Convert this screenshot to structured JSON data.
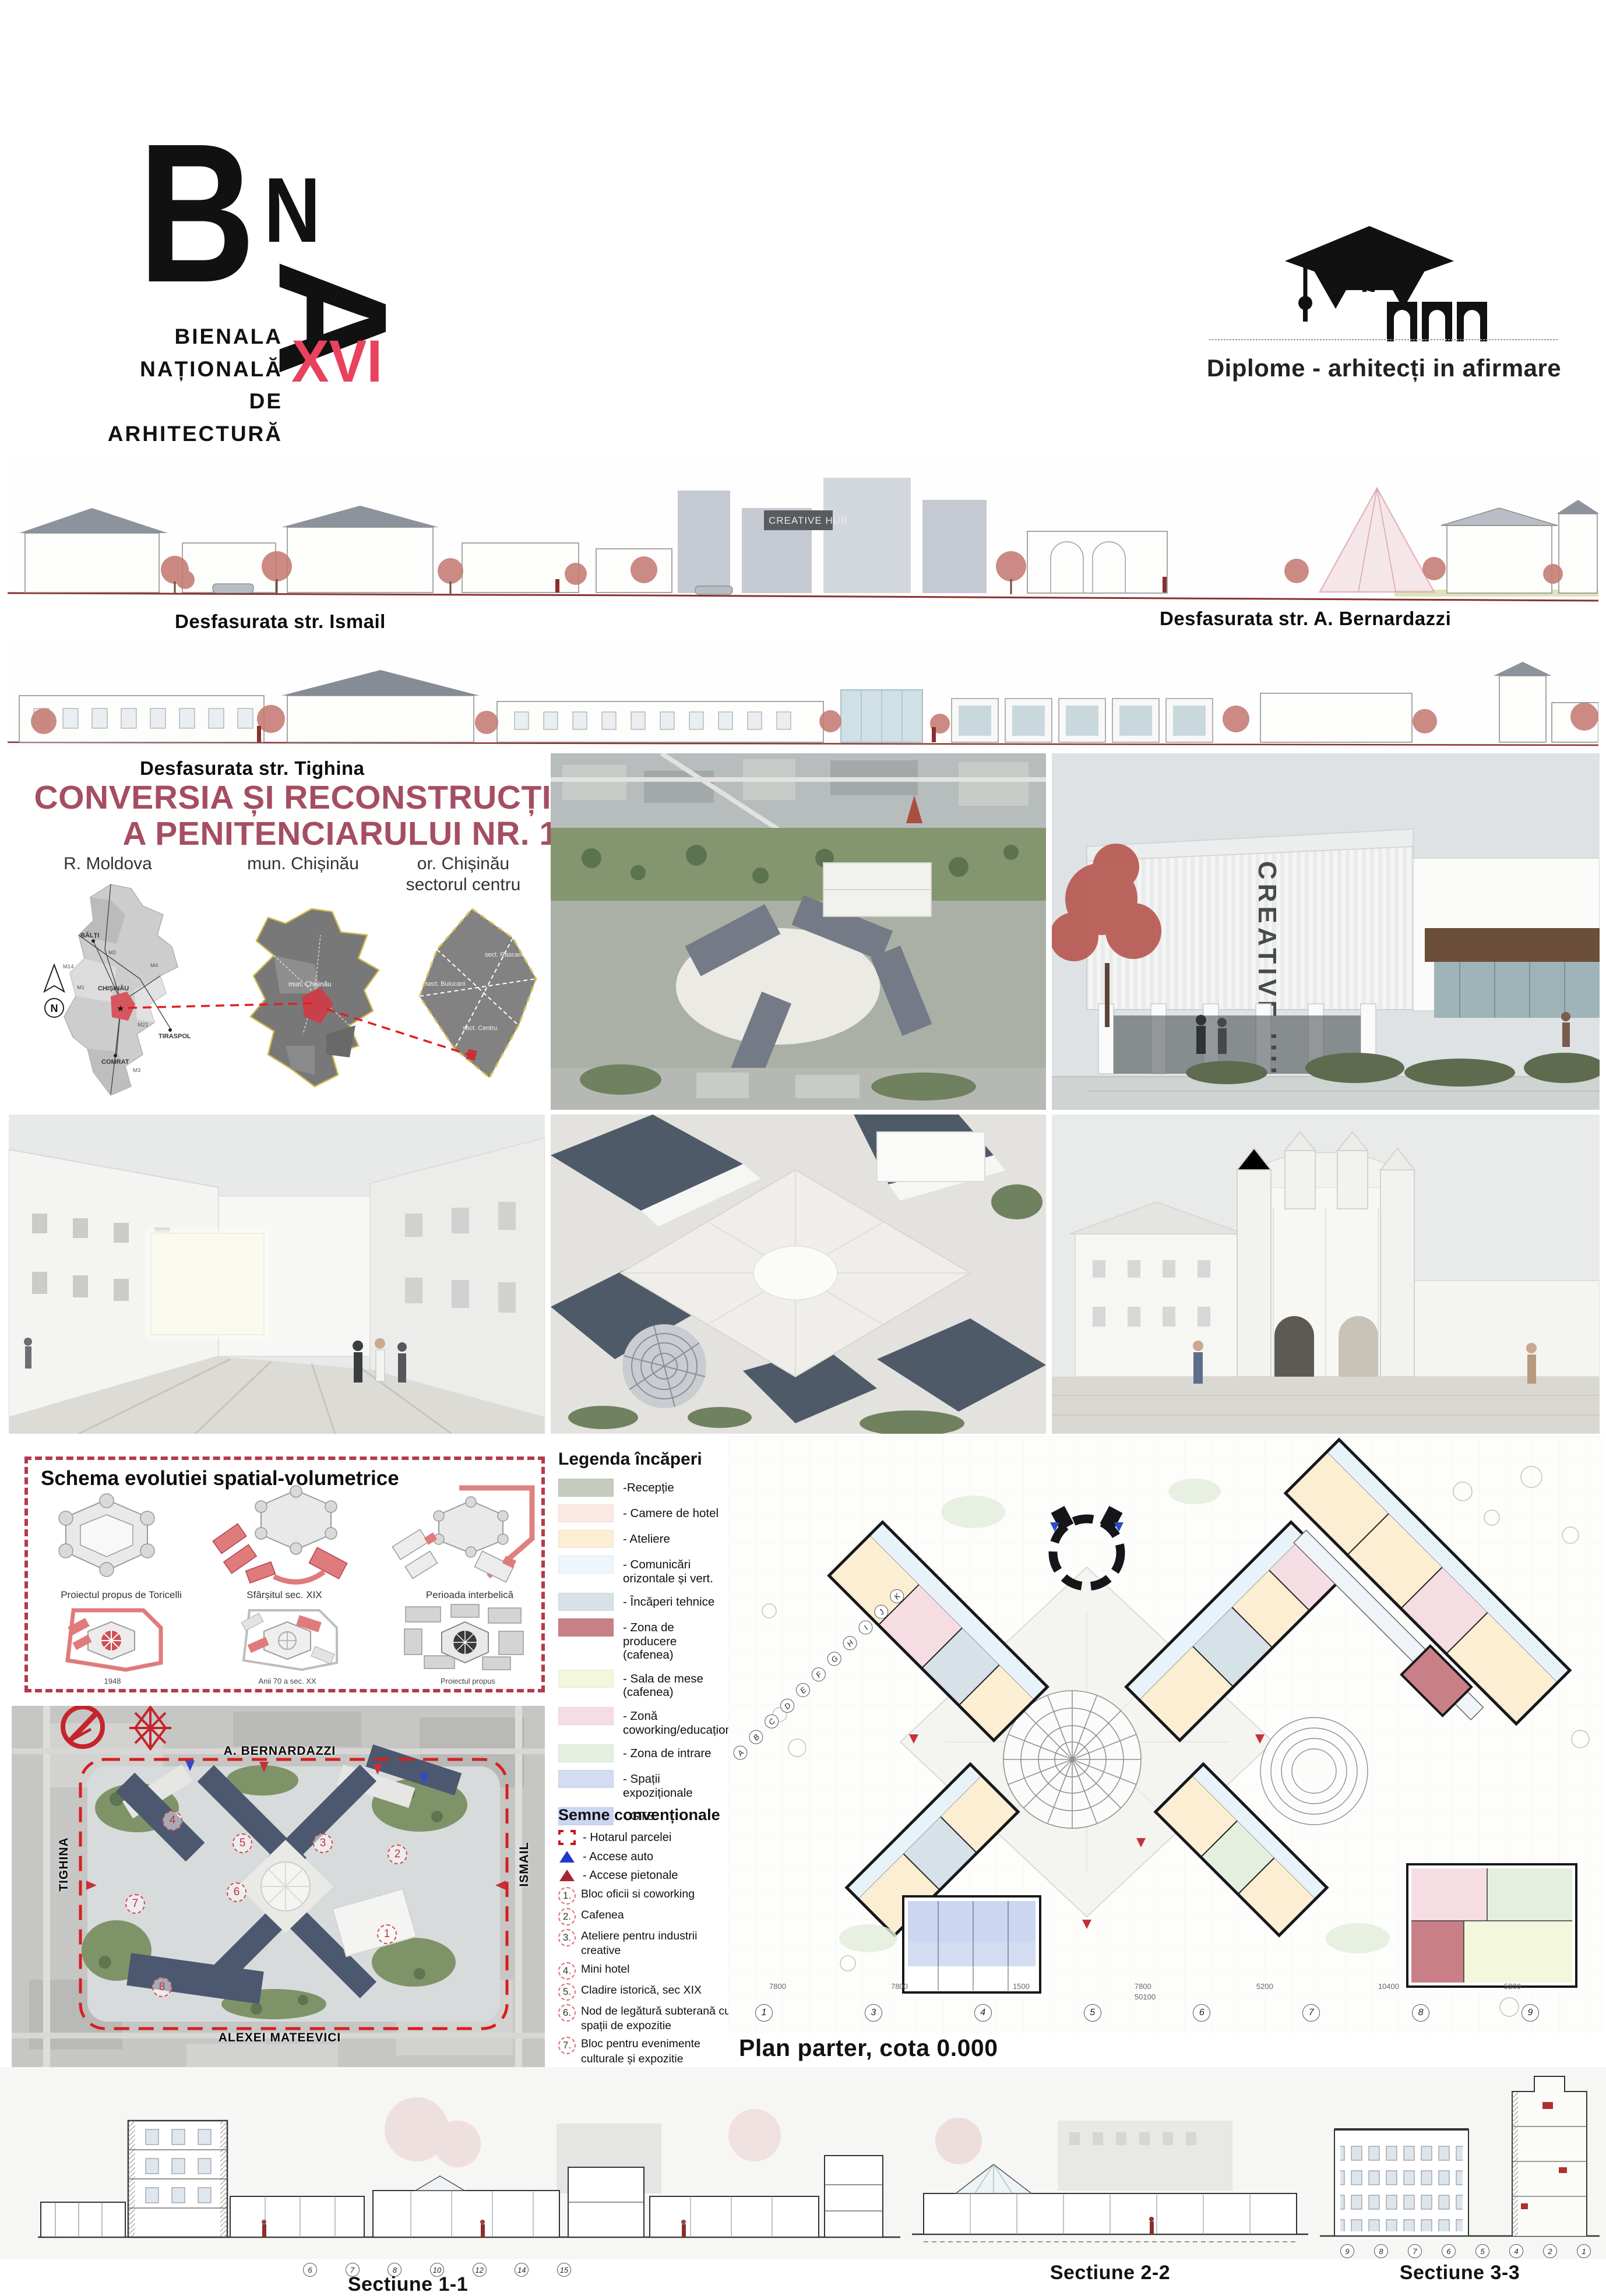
{
  "header": {
    "bna": {
      "letter_b": "B",
      "letter_n": "N",
      "letter_a": "A",
      "title_lines": [
        "BIENALA",
        "NAȚIONALĂ",
        "DE",
        "ARHITECTURĂ"
      ],
      "year": "2025",
      "edition": "XVI"
    },
    "diplome": {
      "label": "Diplome - arhitecți in afirmare"
    }
  },
  "elevations": {
    "ismail": "Desfasurata str. Ismail",
    "bernardazzi": "Desfasurata str. A. Bernardazzi",
    "tighina": "Desfasurata str. Tighina",
    "mateevici": "Desfasurata str. A. Mateevici"
  },
  "project_title": {
    "line1": "CONVERSIA ȘI RECONSTRUCȚIA CLĂDIRII ISTORICE",
    "line2": "A PENITENCIARULUI NR. 13, or. CHIȘINĂU"
  },
  "maps": {
    "north": "N",
    "moldova": {
      "label": "R. Moldova",
      "cities": [
        "BĂLȚI",
        "CHIȘINĂU",
        "TIRASPOL",
        "COMRAT"
      ],
      "roads": [
        "M1",
        "M2",
        "M3",
        "M4",
        "M14",
        "M21"
      ]
    },
    "municipality": {
      "label": "mun. Chișinău",
      "annotation": "mun. Chișinău"
    },
    "sector": {
      "label_line1": "or. Chișinău",
      "label_line2": "sectorul centru",
      "sectors": [
        "sect. Rascani",
        "sect. Buiucani",
        "sect. Centru"
      ]
    }
  },
  "renders": {
    "creative_hub_sign": "CREATIVE HUB"
  },
  "schema": {
    "title": "Schema evolutiei spatial-volumetrice",
    "stages_top": [
      "Proiectul propus de Toricelli",
      "Sfârșitul sec. XIX",
      "Perioada interbelică"
    ],
    "stages_bottom": [
      "1948",
      "Anii 70 a sec. XX",
      "Proiectul propus"
    ]
  },
  "site_plan": {
    "streets": {
      "top": "A. BERNARDAZZI",
      "left": "TIGHINA",
      "right": "ISMAIL",
      "bottom": "ALEXEI MATEEVICI"
    },
    "markers": [
      "1",
      "2",
      "3",
      "4",
      "5",
      "6",
      "7",
      "8"
    ]
  },
  "legend": {
    "title": "Legenda încăperi",
    "items": [
      {
        "color": "#c5cbbd",
        "label": "-Recepție"
      },
      {
        "color": "#fbe9e3",
        "label": "- Camere de hotel"
      },
      {
        "color": "#fceed2",
        "label": "- Ateliere"
      },
      {
        "color": "#edf6fa",
        "label": "- Comunicări orizontale și vert."
      },
      {
        "color": "#d6e1e8",
        "label": "- Încăperi tehnice"
      },
      {
        "color": "#c97f86",
        "label": "- Zona de producere (cafenea)"
      },
      {
        "color": "#f3f7dc",
        "label": "- Sala de mese (cafenea)"
      },
      {
        "color": "#f6dde4",
        "label": "- Zonă coworking/educațional"
      },
      {
        "color": "#e5efdf",
        "label": "- Zona de intrare"
      },
      {
        "color": "#d3dcf0",
        "label": "- Spații expoziționale"
      },
      {
        "color": "#cbd6f1",
        "label": "- GTS"
      }
    ]
  },
  "conventions": {
    "title": "Semne convenționale",
    "boundary_label": "- Hotarul parcelei",
    "auto_label": "- Accese auto",
    "pedestrian_label": "- Accese pietonale",
    "numbered": [
      {
        "n": "1.",
        "label": "Bloc oficii si coworking"
      },
      {
        "n": "2.",
        "label": "Cafenea"
      },
      {
        "n": "3.",
        "label": "Ateliere pentru industrii creative"
      },
      {
        "n": "4.",
        "label": "Mini hotel"
      },
      {
        "n": "5.",
        "label": "Cladire istorică, sec XIX"
      },
      {
        "n": "6.",
        "label": "Nod de legătură subterană cu spații de expozitie"
      },
      {
        "n": "7.",
        "label": "Bloc pentru evenimente culturale și expozitie"
      },
      {
        "n": "8.",
        "label": "Spațiu pentru activități culturale în aer liber"
      }
    ]
  },
  "floor_plan": {
    "label": "Plan parter, cota 0.000",
    "grid_numbers": [
      "1",
      "3",
      "4",
      "5",
      "6",
      "7",
      "8",
      "9"
    ],
    "grid_letters": [
      "A",
      "B",
      "C",
      "D",
      "E",
      "F",
      "G",
      "H",
      "I",
      "J",
      "K"
    ],
    "dims": [
      "7800",
      "7800",
      "1500",
      "7800",
      "5200",
      "10400",
      "5200"
    ],
    "total_dim": "50100"
  },
  "sections": {
    "s1": {
      "label": "Sectiune 1-1",
      "bubbles": [
        "6",
        "7",
        "8",
        "10",
        "12",
        "14",
        "15"
      ]
    },
    "s2": {
      "label": "Sectiune 2-2"
    },
    "s3": {
      "label": "Sectiune 3-3",
      "bubbles": [
        "9",
        "8",
        "7",
        "6",
        "5",
        "4",
        "2",
        "1"
      ]
    }
  },
  "colors": {
    "accent": "#e8425f",
    "title": "#a54e62",
    "schema_border": "#b43a4c",
    "site_boundary": "#d61f1f"
  }
}
